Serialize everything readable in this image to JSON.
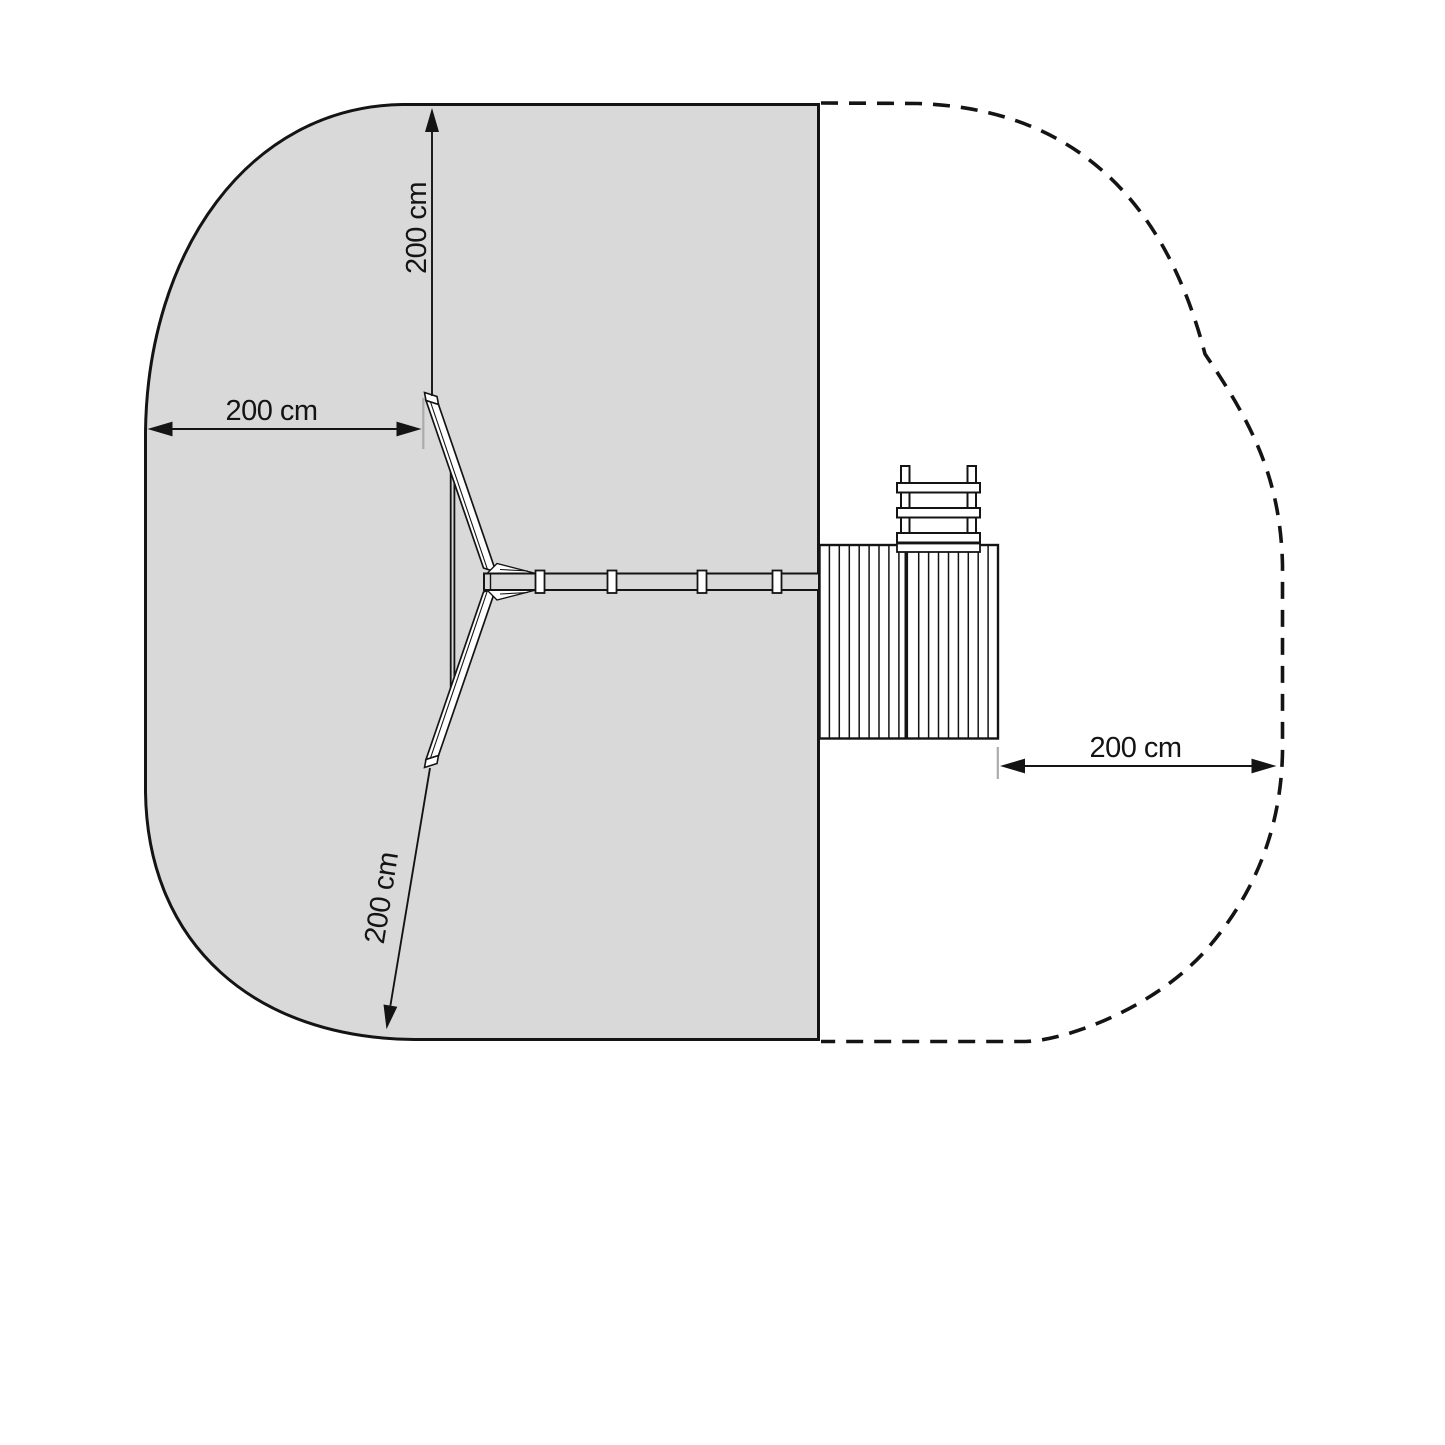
{
  "dimensions": {
    "top": "200 cm",
    "left": "200 cm",
    "diagonal": "200 cm",
    "right": "200 cm"
  },
  "colors": {
    "zone_fill": "#d9d9d9",
    "line": "#141414",
    "tick": "#ababab"
  }
}
